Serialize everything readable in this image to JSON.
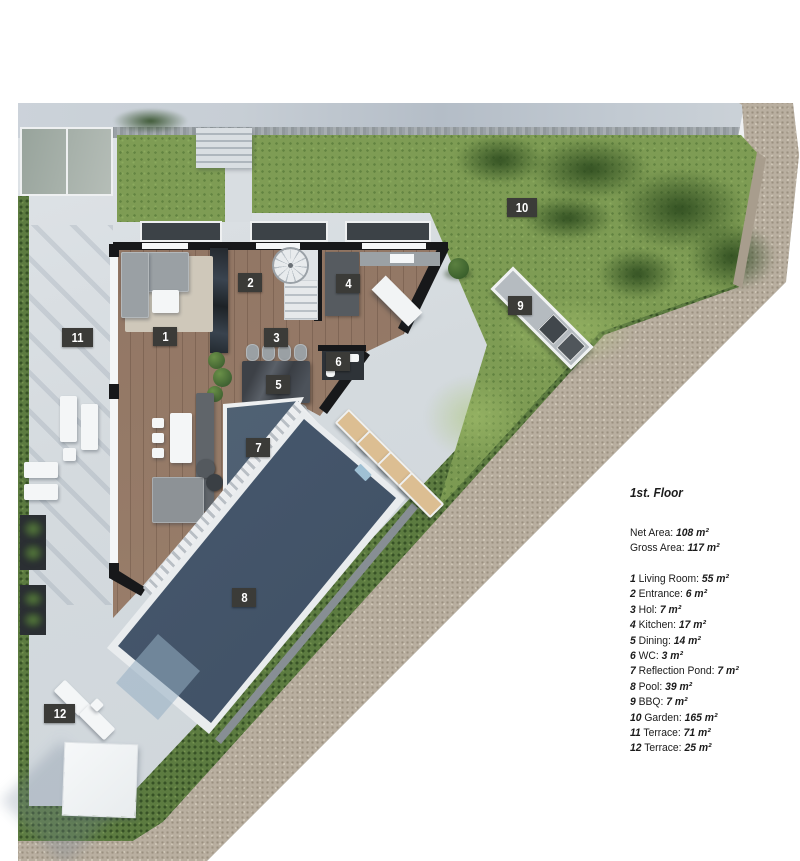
{
  "legend": {
    "title": "1st. Floor",
    "net_label": "Net Area:",
    "net_value": "108 m²",
    "gross_label": "Gross Area:",
    "gross_value": "117 m²",
    "rooms": [
      {
        "num": "1",
        "label": "Living Room:",
        "area": "55 m²"
      },
      {
        "num": "2",
        "label": "Entrance:",
        "area": "6 m²"
      },
      {
        "num": "3",
        "label": "Hol:",
        "area": "7 m²"
      },
      {
        "num": "4",
        "label": "Kitchen:",
        "area": "17 m²"
      },
      {
        "num": "5",
        "label": "Dining:",
        "area": "14 m²"
      },
      {
        "num": "6",
        "label": "WC:",
        "area": "3 m²"
      },
      {
        "num": "7",
        "label": "Reflection Pond:",
        "area": "7 m²"
      },
      {
        "num": "8",
        "label": "Pool:",
        "area": "39 m²"
      },
      {
        "num": "9",
        "label": "BBQ:",
        "area": "7 m²"
      },
      {
        "num": "10",
        "label": "Garden:",
        "area": "165 m²"
      },
      {
        "num": "11",
        "label": "Terrace:",
        "area": "71 m²"
      },
      {
        "num": "12",
        "label": "Terrace:",
        "area": "25 m²"
      }
    ]
  }
}
